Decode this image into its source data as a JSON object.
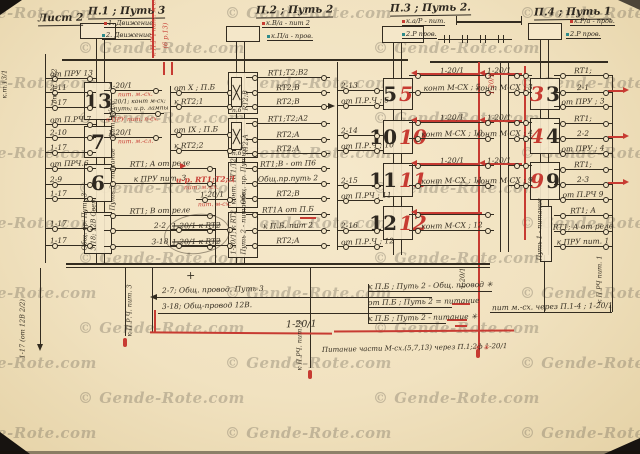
{
  "watermark": {
    "text": "© Gende-Rote.com"
  },
  "sheet": {
    "label": "Лист 2"
  },
  "edge": {
    "top_a": "к.т.13/1",
    "top_b": "от т.13/2",
    "bottom": "1-17 (от 12В 2/2)"
  },
  "headers": {
    "g1": {
      "title": "П.1 ; Путь 3",
      "sub1": "1. Движение",
      "sub2": "2. Движение"
    },
    "g2": {
      "title": "П.2 ; Путь 2",
      "sub1": "к.В/а - пит 2",
      "sub2": "к.П/а - пров."
    },
    "g3": {
      "title": "П.3 ; Путь 2.",
      "sub1": "к.а/Р - пит.",
      "sub2": "2.Р пров."
    },
    "g4": {
      "title": "П.4 ; Путь 1",
      "sub1": "к.Р/а - пров.",
      "sub2": "2.Р пров."
    }
  },
  "g1": {
    "blocks": [
      "13",
      "7",
      "6"
    ],
    "block4a": "Общ. пр. Путь 3",
    "block4b": "3-18; 12В Свет",
    "rail_label": "Путь 3 - питание",
    "rail_label2": "Пит. М-сх.",
    "top_red_a": "к П.РЧ пит. м-сх.",
    "top_red_b": "(6 р.13)",
    "left": [
      "от ПРУ 13",
      "2-11",
      "1-17",
      "от П.РЧ 7",
      "2-10",
      "1-17",
      "от ПРЧ.6",
      "2-9",
      "1-17",
      "1-17",
      "1-17"
    ],
    "right": {
      "r1": "1-20/1",
      "r1r": "пит. м.-сх.",
      "r2a": "1-20/1; конт м-сх;",
      "r2b": "3 путь; и.р. лампы",
      "r3": "к ПРУ пит. п-сх.",
      "r4": "1-20/1",
      "r4r": "пит. м.-сл.",
      "r5": "RT1; A от реле",
      "r6": "к ПРУ пит. 3",
      "r7": "RT1; B от реле",
      "r8": "2-2",
      "r9": "3-18"
    }
  },
  "g2": {
    "blk1": "RT2;B",
    "blk1b": "п.б",
    "blk2": "RT2;A",
    "blk2b": "п.б",
    "blk3a": "Общ. пр. Путь 2",
    "blk3b": "конт. RT1;Т2",
    "blk4a": "1-20/1; к RT2",
    "blk4b": "Путь 2 - питание",
    "left": [
      "от X ; П.Б",
      "к RT2;1",
      "от IX ; П.Б",
      "к RT2;2"
    ],
    "left_red1": "и-р. RT1;Т2;Д",
    "left_red1b": "пит. м.-сх.",
    "left2": "1-20/1",
    "left_red2": "пит. м-сх.",
    "left_x1": "1-20/1 к RT2",
    "left_x2": "1-20/1 к RT2",
    "right": [
      "RT1;T2;B2",
      "RT2;B",
      "RT2;B",
      "RT1;T2;A2",
      "RT2;A",
      "RT2;A",
      "RT1;B - от П6",
      "Общ.пр.путь 2",
      "RT2;B",
      "RT1А от П.Б",
      "к П.Б. пит 2",
      "RT2;А"
    ]
  },
  "g3": {
    "blocks": [
      [
        "5",
        "5"
      ],
      [
        "10",
        "10"
      ],
      [
        "11",
        "11"
      ],
      [
        "12",
        "12"
      ]
    ],
    "left": [
      "2-13",
      "от П.Р.Ч ; 5",
      "2-14",
      "от П.Р.Ч ; 10",
      "2-15",
      "от П.РЧ ; 11",
      "2-16",
      "от П.Р.Ч ; 12"
    ],
    "mid": [
      "1-20/1",
      "конт М-СХ ; 5",
      "1-20/1",
      "конт М-СХ ; 10",
      "1-20/1",
      "конт М-СХ ; 11",
      "конт М-СХ ; 12"
    ],
    "outer": [
      "1-20/1",
      "конт М-СХ ; 3",
      "1-20/1",
      "конт М-СХ ; 4",
      "1-20/1",
      "конт М-СХ ; 9"
    ],
    "red_vert": "1-20/1"
  },
  "g4": {
    "blocks": [
      [
        "3",
        "3"
      ],
      [
        "4",
        "4"
      ],
      [
        "9",
        "9"
      ]
    ],
    "rail_label": "Путь 1 - питание",
    "right": [
      "RT1;",
      "2-1",
      "от ПРУ ; 3",
      "RT1;",
      "2-2",
      "от ПРУ ; 4",
      "RT1;",
      "2-3",
      "от П.РЧ 9",
      "RT1; A",
      "RT1; A от реле",
      "к ПРУ пит. 1"
    ]
  },
  "bottom": {
    "b1": "2-7; Общ. провод. Путь 3",
    "b2": "3-18; Общ-провод 12В.",
    "b3": "1-20/1",
    "b4": "Питание части М-сх.(5,7,13) через П.1;2ф 1-20/1",
    "b4s": "✳ ✳",
    "b5": "к П.Б ; Путь 2 - Общ. провод ✳",
    "b6": "от П.Б ; Путь 2 = питание",
    "b7": "к П.Б ; Путь 2 - питание ✳",
    "b8": "пит м.-сх. через П.1-4 ; 1-20/1",
    "v1": "к П.Р.Ч. пит. 3",
    "v2": "к П.РЧ. пит. 2",
    "v3": "к П.РЧ пит. 1",
    "v4": "1-20/1",
    "plus": "+"
  }
}
